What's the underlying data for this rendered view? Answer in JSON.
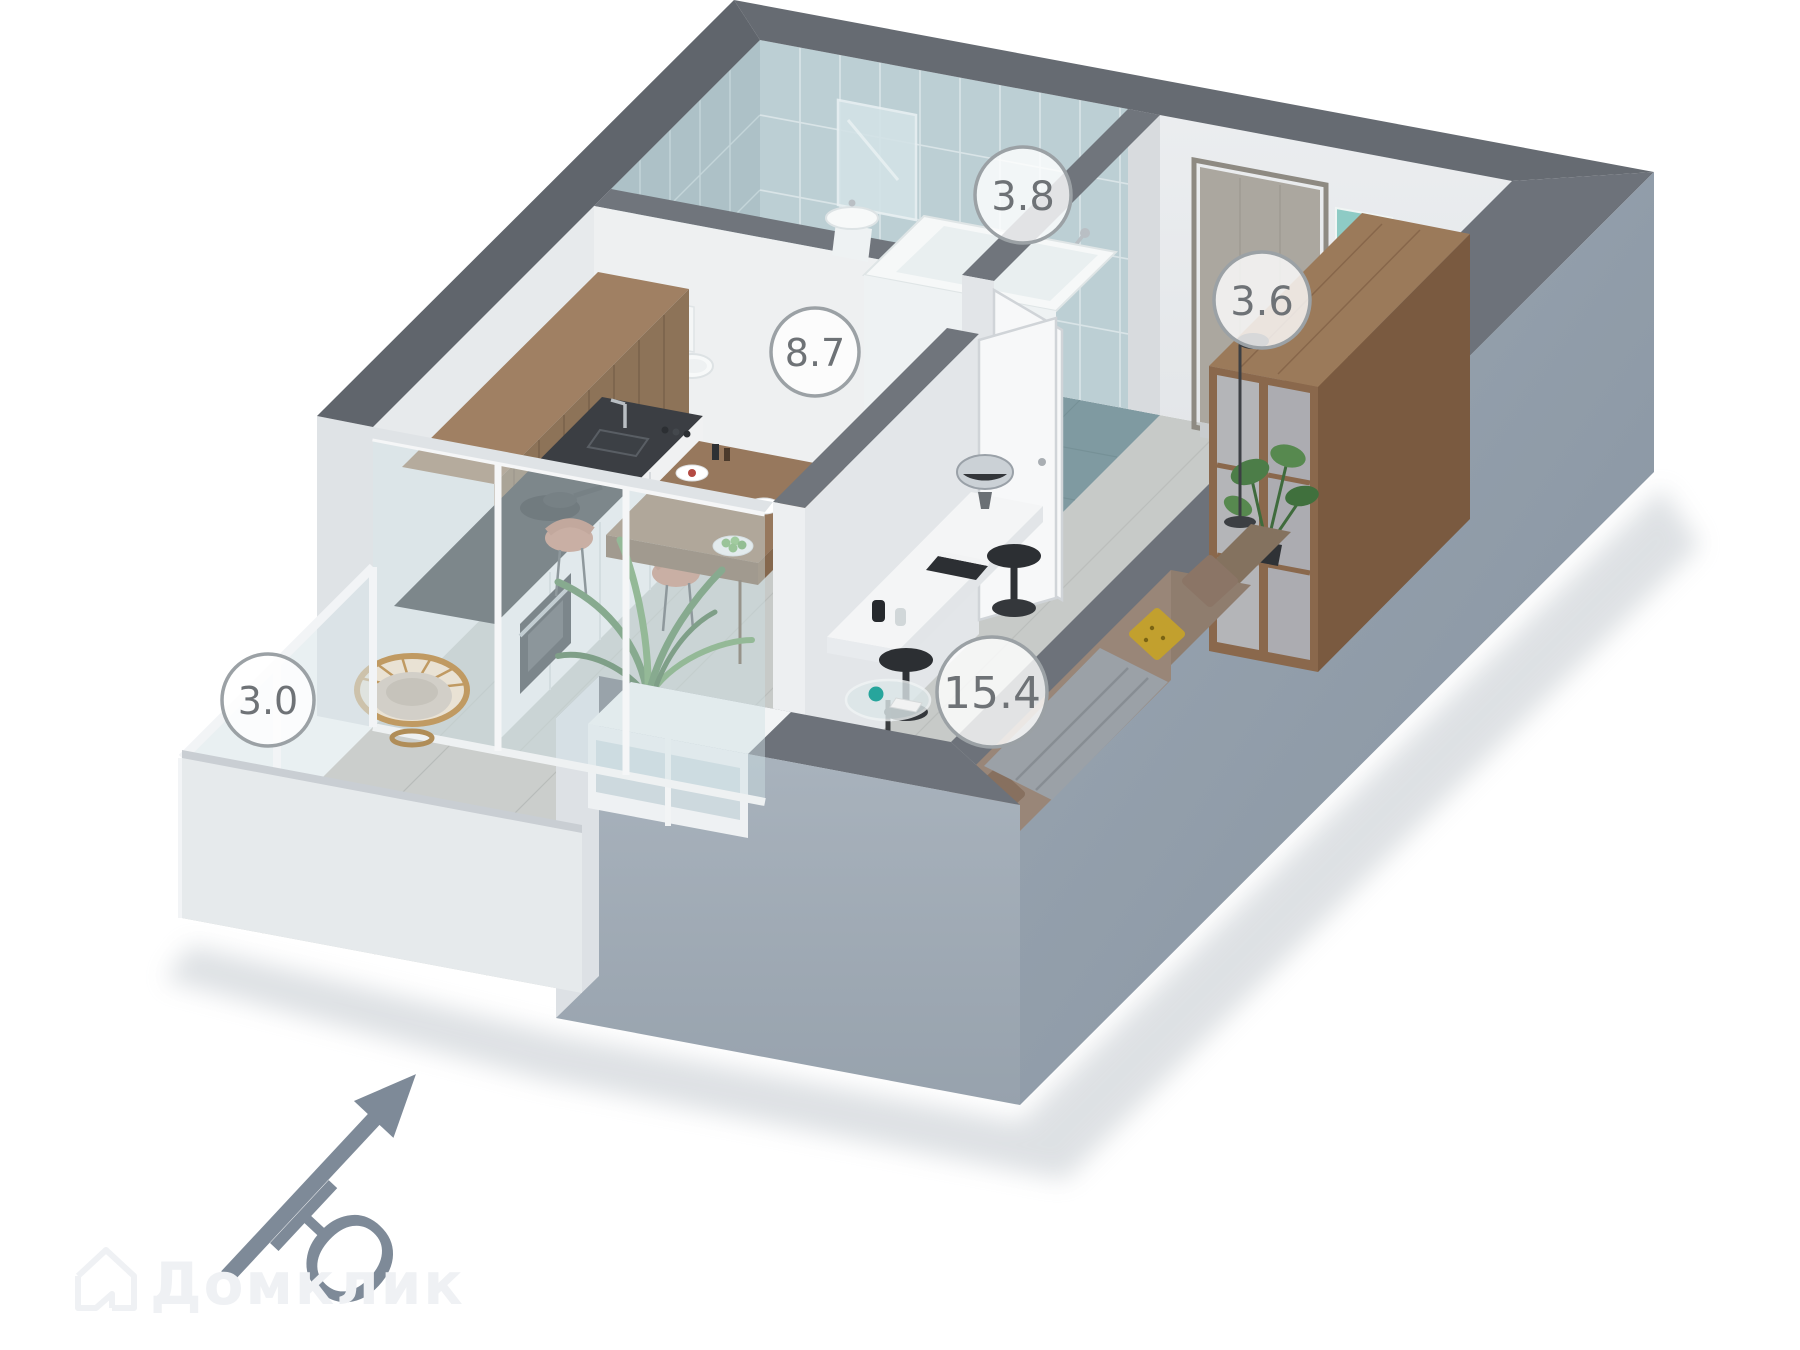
{
  "page": {
    "background": "#ffffff"
  },
  "rooms": [
    {
      "id": "bathroom",
      "area": "3.8"
    },
    {
      "id": "hallway",
      "area": "3.6"
    },
    {
      "id": "kitchen",
      "area": "8.7"
    },
    {
      "id": "balcony",
      "area": "3.0"
    },
    {
      "id": "living-room",
      "area": "15.4"
    }
  ],
  "compass": {
    "label": "Ю"
  },
  "watermark": {
    "brand": "Домклик"
  },
  "decor": {
    "wall_art_text": "Way"
  },
  "colors": {
    "wall_top": "#666b72",
    "wall_face": "#e9ecee",
    "exterior_east": "#97a3b0",
    "exterior_south": "#a5b0bb",
    "floor": "#c7cac8",
    "tile_wall": "#bccfd4",
    "tile_floor": "#7f9aa1",
    "cabinet_wood": "#8d7358",
    "counter": "#3b3e43",
    "wardrobe_wood": "#8a684c",
    "sofa": "#8f7d6e",
    "chair": "#c5876f",
    "label_text": "#6e7276",
    "compass": "#7e8a98"
  }
}
